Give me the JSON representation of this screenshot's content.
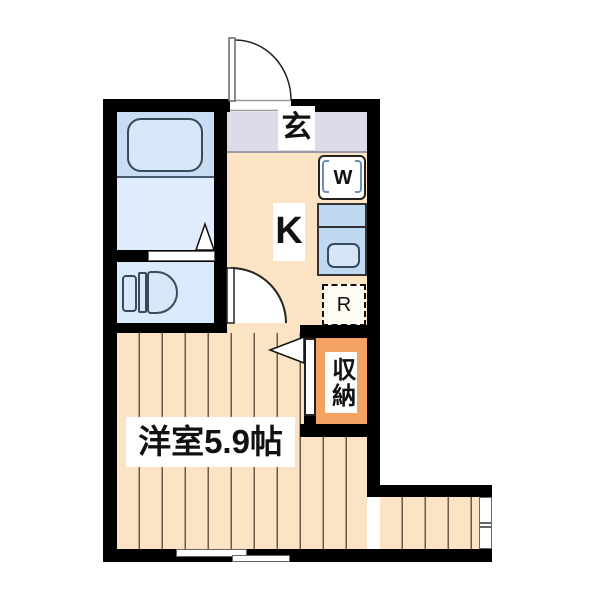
{
  "plan": {
    "type": "japanese-apartment-floor-plan",
    "labels": {
      "entrance": "玄",
      "kitchen": "K",
      "washer": "W",
      "refrigerator": "R",
      "closet": "収納",
      "main_room": "洋室5.9帖"
    },
    "colors": {
      "wall": "#000000",
      "kitchen_floor": "#fbe3c3",
      "wood_floor_line": "#6b5b4b",
      "entrance_floor": "#dcdce8",
      "bath_upper": "#c8dcf4",
      "bath_lower": "#deecfb",
      "toilet_floor": "#d9eafb",
      "fixture_fill": "#d8e8fa",
      "counter": "#bfd9f2",
      "sink": "#d5e6f8",
      "closet_fill": "#f4a263"
    }
  }
}
